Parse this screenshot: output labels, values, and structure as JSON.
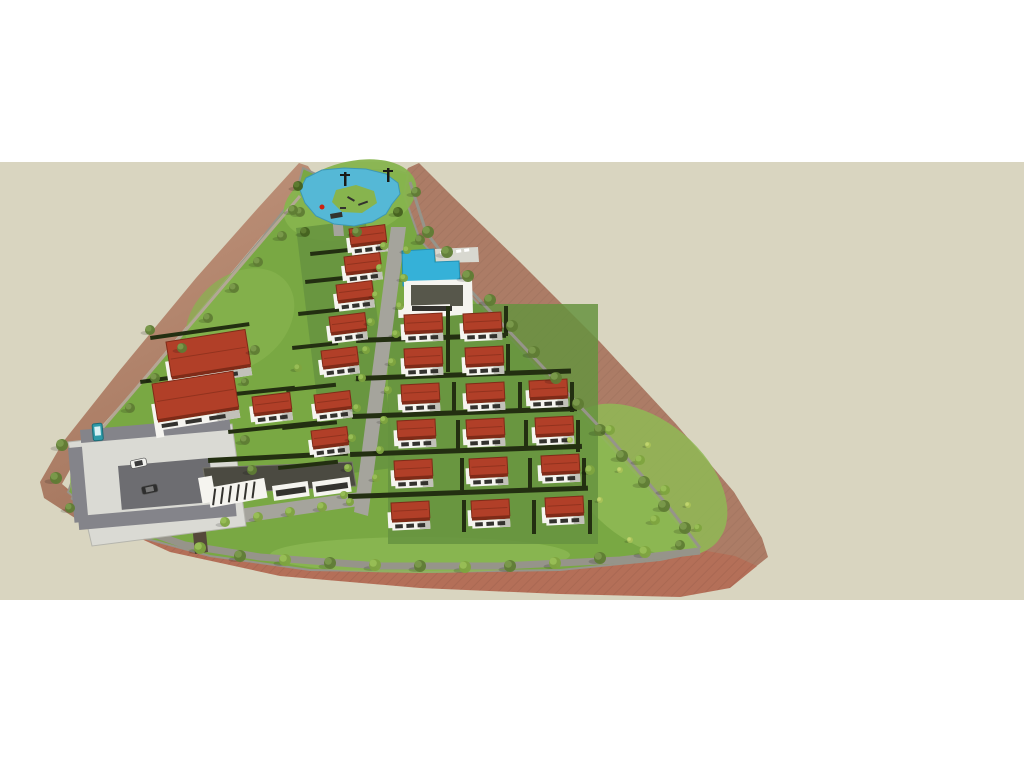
{
  "scene": {
    "description": "aerial-3d-render-of-triangular-residential-villa-development",
    "canvas": {
      "width": 1024,
      "height": 768
    },
    "ground_band": {
      "top": 162,
      "bottom": 600
    },
    "counts": {
      "villas": 24,
      "twin_villas": 2,
      "trees": "many",
      "vehicles": 3
    }
  },
  "palette": {
    "white": "#ffffff",
    "tan": "#d9d5c0",
    "slope_light": "#c59a82",
    "slope_dark": "#a2735b",
    "slope_right": "#ac7c66",
    "field_red": "#b46f58",
    "field_hatch": "#9e5d46",
    "grass_base": "#79a843",
    "grass_park": "#87b44e",
    "grass_light": "#8fba55",
    "grass_lot": "#669340",
    "hedge": "#232f11",
    "road": "#a5a49c",
    "road_dark": "#55483a",
    "perim_road": "#96948a",
    "wall_light": "#b3a795",
    "pavement": "#dadad4",
    "stall": "#84848a",
    "stall_dark": "#6d6d71",
    "water": "#55b8d6",
    "pool": "#35b1d8",
    "deck": "#d8d8d0",
    "roof_red": "#b13f28",
    "roof_dark": "#7f2b18",
    "wall": "#f5f4ef",
    "wall_shade": "#c2c1b9",
    "glass": "#33322e",
    "comm_roof": "#4b4a41",
    "tree_olive": "#5f7c34",
    "tree_olive2": "#79984a",
    "tree_bright": "#7ea43f",
    "tree_bright2": "#97bd55",
    "tree_dark": "#44601f",
    "tree_dark2": "#5d7c30",
    "bush_yellow": "#a9c257",
    "bush_yellow2": "#c0d46e",
    "bus_teal": "#2e9aa8",
    "car_white": "#f2f2ee",
    "car_dark": "#2e2e2e",
    "post_dark": "#1a1a16",
    "play_red": "#cc2211"
  },
  "terrain": {
    "left_slope": [
      [
        299,
        163
      ],
      [
        258,
        208
      ],
      [
        196,
        278
      ],
      [
        120,
        370
      ],
      [
        63,
        442
      ],
      [
        40,
        482
      ],
      [
        44,
        498
      ],
      [
        78,
        520
      ],
      [
        110,
        532
      ],
      [
        96,
        508
      ],
      [
        74,
        494
      ],
      [
        62,
        484
      ],
      [
        82,
        448
      ],
      [
        130,
        394
      ],
      [
        200,
        310
      ],
      [
        262,
        236
      ],
      [
        300,
        196
      ],
      [
        316,
        178
      ],
      [
        308,
        166
      ]
    ],
    "right_slope": [
      [
        419,
        163
      ],
      [
        452,
        196
      ],
      [
        520,
        262
      ],
      [
        600,
        342
      ],
      [
        676,
        424
      ],
      [
        734,
        492
      ],
      [
        762,
        538
      ],
      [
        768,
        557
      ],
      [
        744,
        576
      ],
      [
        716,
        583
      ],
      [
        700,
        556
      ],
      [
        688,
        536
      ],
      [
        640,
        480
      ],
      [
        560,
        394
      ],
      [
        470,
        300
      ],
      [
        416,
        240
      ],
      [
        398,
        205
      ],
      [
        402,
        180
      ],
      [
        408,
        168
      ]
    ],
    "field": [
      [
        62,
        486
      ],
      [
        100,
        520
      ],
      [
        170,
        552
      ],
      [
        280,
        576
      ],
      [
        420,
        588
      ],
      [
        560,
        594
      ],
      [
        680,
        597
      ],
      [
        730,
        588
      ],
      [
        757,
        566
      ],
      [
        735,
        556
      ],
      [
        690,
        548
      ],
      [
        600,
        560
      ],
      [
        480,
        570
      ],
      [
        360,
        570
      ],
      [
        250,
        560
      ],
      [
        170,
        542
      ],
      [
        110,
        515
      ],
      [
        80,
        498
      ]
    ],
    "site": [
      [
        303,
        168
      ],
      [
        316,
        174
      ],
      [
        338,
        172
      ],
      [
        368,
        170
      ],
      [
        394,
        170
      ],
      [
        408,
        174
      ],
      [
        404,
        195
      ],
      [
        420,
        240
      ],
      [
        470,
        295
      ],
      [
        560,
        392
      ],
      [
        640,
        478
      ],
      [
        690,
        538
      ],
      [
        700,
        552
      ],
      [
        660,
        560
      ],
      [
        560,
        570
      ],
      [
        430,
        572
      ],
      [
        310,
        570
      ],
      [
        210,
        556
      ],
      [
        140,
        537
      ],
      [
        95,
        515
      ],
      [
        68,
        492
      ],
      [
        82,
        452
      ],
      [
        130,
        396
      ],
      [
        200,
        312
      ],
      [
        262,
        238
      ],
      [
        295,
        196
      ]
    ],
    "lawn_blobs": [
      [
        350,
        200,
        68,
        38,
        -15,
        "grass_park",
        0.95
      ],
      [
        645,
        480,
        95,
        60,
        40,
        "grass_light",
        0.85
      ],
      [
        420,
        555,
        150,
        18,
        0,
        "grass_light",
        0.7
      ],
      [
        140,
        480,
        70,
        50,
        0,
        "grass_light",
        0.8
      ],
      [
        240,
        320,
        60,
        45,
        -40,
        "grass_park",
        0.7
      ]
    ],
    "lot_zones": [
      [
        296,
        228,
        70,
        250,
        -7
      ],
      [
        388,
        304,
        210,
        240,
        0
      ]
    ]
  },
  "roads": {
    "main": [
      [
        391,
        227
      ],
      [
        406,
        227
      ],
      [
        368,
        516
      ],
      [
        354,
        512
      ]
    ],
    "front": [
      [
        146,
        522
      ],
      [
        360,
        492
      ],
      [
        366,
        505
      ],
      [
        152,
        536
      ]
    ],
    "pond_path": [
      [
        330,
        194
      ],
      [
        340,
        194
      ],
      [
        344,
        236
      ],
      [
        334,
        236
      ]
    ],
    "entrance": [
      [
        188,
        484
      ],
      [
        201,
        482
      ],
      [
        208,
        552
      ],
      [
        195,
        554
      ]
    ],
    "perimeter_right": [
      [
        410,
        182
      ],
      [
        426,
        232
      ],
      [
        470,
        290
      ],
      [
        540,
        364
      ],
      [
        610,
        438
      ],
      [
        668,
        506
      ],
      [
        700,
        548
      ]
    ],
    "perimeter_bottom": [
      [
        700,
        551
      ],
      [
        620,
        560
      ],
      [
        500,
        566
      ],
      [
        380,
        566
      ],
      [
        260,
        557
      ],
      [
        185,
        545
      ],
      [
        120,
        522
      ],
      [
        72,
        496
      ]
    ],
    "left_wall": [
      [
        82,
        452
      ],
      [
        300,
        196
      ]
    ]
  },
  "pond": {
    "water": [
      [
        306,
        178
      ],
      [
        322,
        170
      ],
      [
        344,
        168
      ],
      [
        366,
        169
      ],
      [
        386,
        174
      ],
      [
        398,
        183
      ],
      [
        400,
        194
      ],
      [
        392,
        204
      ],
      [
        386,
        214
      ],
      [
        372,
        222
      ],
      [
        354,
        226
      ],
      [
        334,
        224
      ],
      [
        316,
        216
      ],
      [
        305,
        203
      ],
      [
        300,
        190
      ]
    ],
    "island": [
      [
        336,
        190
      ],
      [
        356,
        185
      ],
      [
        374,
        191
      ],
      [
        377,
        203
      ],
      [
        362,
        213
      ],
      [
        342,
        212
      ],
      [
        332,
        202
      ]
    ],
    "posts": [
      [
        344,
        172
      ],
      [
        387,
        168
      ]
    ],
    "play_items": [
      [
        348,
        196,
        8,
        2,
        30
      ],
      [
        358,
        204,
        10,
        2,
        -20
      ],
      [
        340,
        207,
        6,
        2,
        0
      ],
      [
        330,
        214,
        12,
        5,
        -10
      ]
    ],
    "red_item": [
      322,
      207
    ]
  },
  "pool_area": {
    "pool": [
      [
        402,
        251
      ],
      [
        434,
        249
      ],
      [
        435,
        262
      ],
      [
        459,
        261
      ],
      [
        460,
        284
      ],
      [
        403,
        286
      ]
    ],
    "deck": [
      [
        435,
        249
      ],
      [
        478,
        247
      ],
      [
        479,
        262
      ],
      [
        436,
        263
      ]
    ],
    "loungers": [
      [
        440,
        252
      ],
      [
        448,
        251
      ],
      [
        456,
        250
      ],
      [
        464,
        249
      ]
    ],
    "club_parapet": [
      [
        404,
        281
      ],
      [
        472,
        279
      ],
      [
        473,
        314
      ],
      [
        447,
        316
      ],
      [
        447,
        308
      ],
      [
        404,
        310
      ]
    ],
    "club_roof": [
      411,
      285,
      52,
      21
    ],
    "club_wing": [
      398,
      306,
      52,
      12,
      -2
    ],
    "club_glass": [
      412,
      306,
      40,
      5
    ]
  },
  "commercial": {
    "roof": [
      [
        203,
        468
      ],
      [
        352,
        462
      ],
      [
        356,
        486
      ],
      [
        207,
        494
      ]
    ],
    "glazed": [
      207,
      488,
      58,
      20,
      -10
    ],
    "sections": [
      [
        272,
        486,
        36,
        15,
        -8
      ],
      [
        312,
        482,
        38,
        15,
        -8
      ]
    ],
    "end_piece": [
      198,
      478,
      14,
      26,
      -10
    ]
  },
  "parking": {
    "slab": [
      [
        68,
        442
      ],
      [
        232,
        424
      ],
      [
        246,
        526
      ],
      [
        92,
        546
      ]
    ],
    "bands": [
      [
        80,
        430,
        150,
        13,
        -5
      ],
      [
        118,
        466,
        92,
        44,
        -5
      ],
      [
        78,
        516,
        158,
        14,
        -5
      ],
      [
        68,
        448,
        14,
        75,
        -5
      ]
    ]
  },
  "houses": [
    [
      349,
      229,
      36,
      -7
    ],
    [
      344,
      257,
      36,
      -7
    ],
    [
      336,
      285,
      36,
      -7
    ],
    [
      329,
      317,
      36,
      -7
    ],
    [
      321,
      351,
      36,
      -7
    ],
    [
      314,
      395,
      36,
      -7
    ],
    [
      311,
      431,
      36,
      -7
    ],
    [
      252,
      397,
      38,
      -7
    ],
    [
      404,
      315,
      38,
      -3
    ],
    [
      463,
      314,
      38,
      -3
    ],
    [
      404,
      349,
      38,
      -3
    ],
    [
      465,
      348,
      38,
      -3
    ],
    [
      401,
      385,
      38,
      -3
    ],
    [
      466,
      384,
      38,
      -3
    ],
    [
      529,
      381,
      38,
      -3
    ],
    [
      397,
      421,
      38,
      -3
    ],
    [
      466,
      420,
      38,
      -3
    ],
    [
      535,
      418,
      38,
      -3
    ],
    [
      394,
      461,
      38,
      -3
    ],
    [
      469,
      459,
      38,
      -3
    ],
    [
      541,
      456,
      38,
      -3
    ],
    [
      391,
      503,
      38,
      -3
    ],
    [
      471,
      501,
      38,
      -3
    ],
    [
      545,
      498,
      38,
      -3
    ]
  ],
  "big_houses": [
    [
      166,
      342,
      80,
      -9
    ],
    [
      152,
      384,
      82,
      -9
    ]
  ],
  "hedges": [
    [
      356,
      338,
      150,
      5,
      -2
    ],
    [
      356,
      376,
      215,
      5,
      -2
    ],
    [
      352,
      414,
      225,
      5,
      -2
    ],
    [
      350,
      452,
      232,
      5,
      -2
    ],
    [
      348,
      494,
      240,
      5,
      -2
    ],
    [
      446,
      306,
      4,
      66,
      0
    ],
    [
      452,
      382,
      4,
      30,
      0
    ],
    [
      456,
      420,
      4,
      30,
      0
    ],
    [
      460,
      458,
      4,
      32,
      0
    ],
    [
      462,
      500,
      4,
      32,
      0
    ],
    [
      518,
      382,
      4,
      30,
      0
    ],
    [
      524,
      420,
      4,
      30,
      0
    ],
    [
      528,
      458,
      4,
      32,
      0
    ],
    [
      532,
      500,
      4,
      34,
      0
    ],
    [
      504,
      306,
      4,
      30,
      0
    ],
    [
      506,
      344,
      4,
      30,
      0
    ],
    [
      570,
      382,
      4,
      30,
      0
    ],
    [
      576,
      420,
      4,
      32,
      0
    ],
    [
      582,
      458,
      4,
      32,
      0
    ],
    [
      588,
      500,
      4,
      34,
      0
    ],
    [
      310,
      252,
      40,
      4,
      -6
    ],
    [
      305,
      280,
      42,
      4,
      -6
    ],
    [
      298,
      312,
      44,
      4,
      -6
    ],
    [
      292,
      346,
      46,
      4,
      -6
    ],
    [
      286,
      388,
      50,
      4,
      -6
    ],
    [
      282,
      426,
      55,
      4,
      -6
    ],
    [
      278,
      466,
      60,
      4,
      -6
    ],
    [
      150,
      336,
      100,
      4,
      -8
    ],
    [
      140,
      380,
      105,
      4,
      -8
    ],
    [
      235,
      392,
      60,
      4,
      -6
    ],
    [
      228,
      430,
      92,
      4,
      -6
    ],
    [
      208,
      458,
      140,
      5,
      -3
    ]
  ],
  "trees": [
    [
      428,
      232,
      6,
      "olive"
    ],
    [
      447,
      252,
      6,
      "olive"
    ],
    [
      468,
      276,
      6,
      "olive"
    ],
    [
      490,
      300,
      6,
      "olive"
    ],
    [
      512,
      326,
      6,
      "olive"
    ],
    [
      534,
      352,
      6,
      "olive"
    ],
    [
      556,
      378,
      6,
      "olive"
    ],
    [
      578,
      404,
      6,
      "olive"
    ],
    [
      600,
      430,
      6,
      "olive"
    ],
    [
      622,
      456,
      6,
      "olive"
    ],
    [
      644,
      482,
      6,
      "olive"
    ],
    [
      664,
      506,
      6,
      "olive"
    ],
    [
      685,
      528,
      6,
      "olive"
    ],
    [
      200,
      548,
      6,
      "bright"
    ],
    [
      240,
      556,
      6,
      "olive"
    ],
    [
      285,
      560,
      6,
      "bright"
    ],
    [
      330,
      563,
      6,
      "olive"
    ],
    [
      375,
      565,
      6,
      "bright"
    ],
    [
      420,
      566,
      6,
      "olive"
    ],
    [
      465,
      567,
      6,
      "bright"
    ],
    [
      510,
      566,
      6,
      "olive"
    ],
    [
      555,
      563,
      6,
      "bright"
    ],
    [
      600,
      558,
      6,
      "olive"
    ],
    [
      645,
      552,
      6,
      "bright"
    ],
    [
      680,
      545,
      5,
      "olive"
    ],
    [
      130,
      408,
      5,
      "olive"
    ],
    [
      155,
      378,
      5,
      "olive"
    ],
    [
      182,
      348,
      5,
      "olive"
    ],
    [
      208,
      318,
      5,
      "olive"
    ],
    [
      234,
      288,
      5,
      "olive"
    ],
    [
      258,
      262,
      5,
      "olive"
    ],
    [
      282,
      236,
      5,
      "olive"
    ],
    [
      300,
      212,
      5,
      "olive"
    ],
    [
      298,
      186,
      5,
      "dark"
    ],
    [
      293,
      210,
      5,
      "olive"
    ],
    [
      305,
      232,
      5,
      "dark"
    ],
    [
      357,
      232,
      5,
      "olive"
    ],
    [
      398,
      212,
      5,
      "dark"
    ],
    [
      416,
      192,
      5,
      "olive"
    ],
    [
      420,
      240,
      5,
      "olive"
    ],
    [
      384,
      246,
      4,
      "bright"
    ],
    [
      380,
      268,
      4,
      "bright"
    ],
    [
      376,
      295,
      4,
      "bright"
    ],
    [
      371,
      322,
      4,
      "bright"
    ],
    [
      366,
      350,
      4,
      "bright"
    ],
    [
      362,
      378,
      4,
      "bright"
    ],
    [
      357,
      408,
      4,
      "bright"
    ],
    [
      352,
      438,
      4,
      "bright"
    ],
    [
      348,
      468,
      4,
      "bright"
    ],
    [
      344,
      495,
      4,
      "bright"
    ],
    [
      407,
      250,
      4,
      "bright"
    ],
    [
      404,
      278,
      4,
      "bright"
    ],
    [
      400,
      306,
      4,
      "bright"
    ],
    [
      396,
      334,
      4,
      "bright"
    ],
    [
      392,
      362,
      4,
      "bright"
    ],
    [
      388,
      390,
      4,
      "bright"
    ],
    [
      384,
      420,
      4,
      "bright"
    ],
    [
      380,
      450,
      4,
      "bright"
    ],
    [
      376,
      478,
      4,
      "bright"
    ],
    [
      225,
      522,
      5,
      "bright"
    ],
    [
      258,
      517,
      5,
      "bright"
    ],
    [
      290,
      512,
      5,
      "bright"
    ],
    [
      322,
      507,
      5,
      "bright"
    ],
    [
      350,
      502,
      4,
      "bright"
    ],
    [
      640,
      460,
      5,
      "bright"
    ],
    [
      665,
      490,
      5,
      "bright"
    ],
    [
      610,
      430,
      5,
      "bright"
    ],
    [
      590,
      470,
      5,
      "bright"
    ],
    [
      655,
      520,
      5,
      "bright"
    ],
    [
      698,
      528,
      4,
      "bright"
    ],
    [
      620,
      470,
      3,
      "yellow"
    ],
    [
      648,
      445,
      3,
      "yellow"
    ],
    [
      688,
      505,
      3,
      "yellow"
    ],
    [
      600,
      500,
      3,
      "yellow"
    ],
    [
      570,
      440,
      3,
      "yellow"
    ],
    [
      630,
      540,
      3,
      "yellow"
    ],
    [
      62,
      445,
      6,
      "olive"
    ],
    [
      56,
      478,
      6,
      "olive"
    ],
    [
      70,
      508,
      5,
      "olive"
    ],
    [
      245,
      440,
      5,
      "olive"
    ],
    [
      252,
      470,
      5,
      "olive"
    ],
    [
      150,
      330,
      5,
      "olive"
    ],
    [
      255,
      350,
      5,
      "olive"
    ],
    [
      245,
      382,
      4,
      "olive"
    ],
    [
      298,
      368,
      4,
      "bright"
    ]
  ],
  "vehicles": {
    "bus": [
      92,
      424,
      10,
      17,
      -5
    ],
    "car_white": [
      130,
      461,
      16,
      8,
      -12
    ],
    "car_dark": [
      141,
      487,
      16,
      8,
      -12
    ]
  }
}
